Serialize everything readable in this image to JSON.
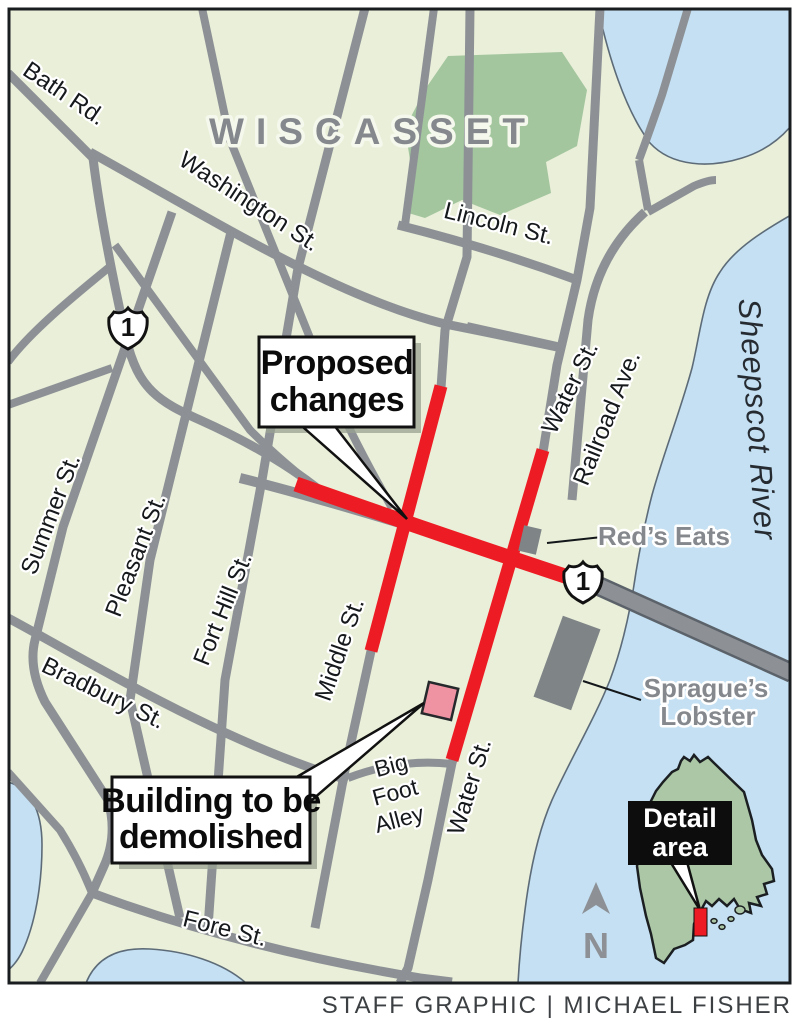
{
  "credit": "STAFF GRAPHIC | MICHAEL FISHER",
  "city_label": "WISCASSET",
  "route_shield": "1",
  "water_label": "Sheepscot River",
  "streets": {
    "bath_rd": "Bath Rd.",
    "washington": "Washington St.",
    "lincoln": "Lincoln St.",
    "summer": "Summer St.",
    "pleasant": "Pleasant St.",
    "fort_hill": "Fort Hill St.",
    "middle": "Middle St.",
    "water_north": "Water St.",
    "water_south": "Water St.",
    "railroad": "Railroad Ave.",
    "bradbury": "Bradbury St.",
    "fore": "Fore St.",
    "big_foot_alley": {
      "line1": "Big",
      "line2": "Foot",
      "line3": "Alley"
    }
  },
  "pois": {
    "reds_eats": "Red’s Eats",
    "spragues_lobster": {
      "line1": "Sprague’s",
      "line2": "Lobster"
    }
  },
  "callouts": {
    "proposed_changes": {
      "line1": "Proposed",
      "line2": "changes"
    },
    "building_demolished": {
      "line1": "Building to be",
      "line2": "demolished"
    }
  },
  "inset": {
    "detail_area": {
      "line1": "Detail",
      "line2": "area"
    },
    "compass_north": "N"
  },
  "map_colors": {
    "land_green": "#E9EFD8",
    "park_green": "#A3C69E",
    "water_blue": "#C4E0F2",
    "road_gray": "#8D9196",
    "proposed_red": "#ED1C24",
    "demolish_pink": "#EF93A2",
    "building_gray": "#7F8487"
  }
}
